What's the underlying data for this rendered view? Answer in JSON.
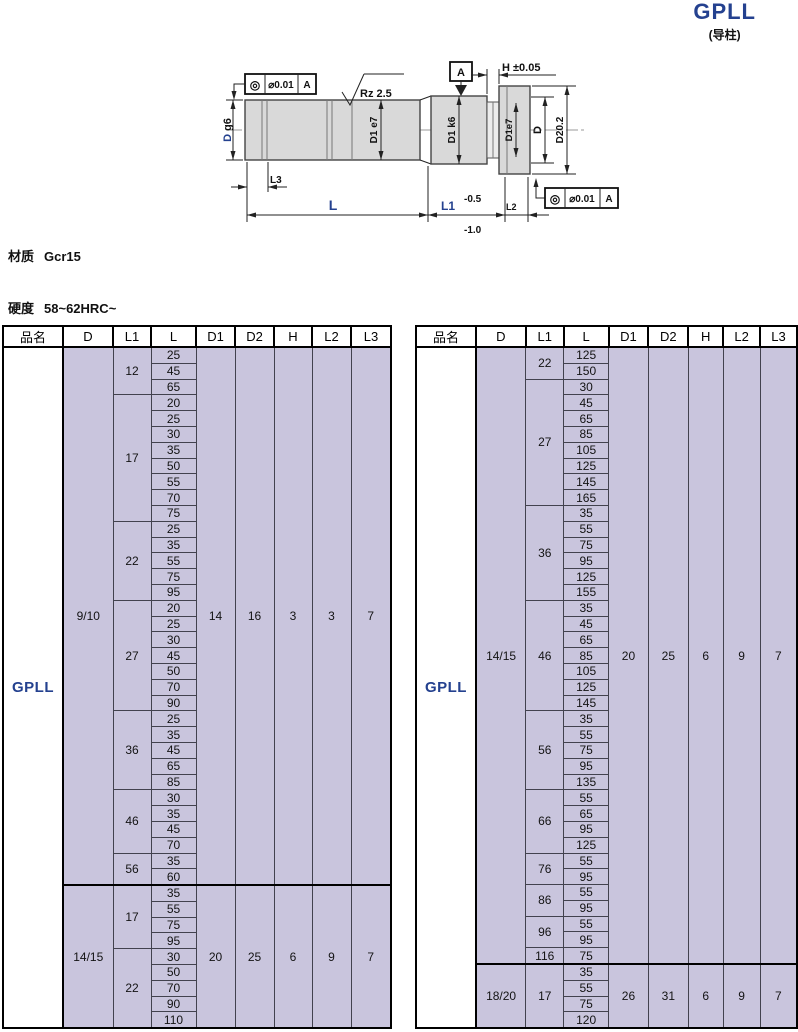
{
  "title": {
    "name": "GPLL",
    "sub": "(导柱)"
  },
  "specs": {
    "material_label": "材质",
    "material_value": "Gcr15",
    "hardness_label": "硬度",
    "hardness_value": "58~62HRC~"
  },
  "drawing": {
    "tolerance_frame": {
      "symbol": "◎",
      "value": "⌀0.01",
      "datum": "A"
    },
    "surface_finish": "Rz 2.5",
    "datum_label": "A",
    "h_dim": "H ±0.05",
    "d_label": "D",
    "d_fit": "g6",
    "d1_e7": "D1 e7",
    "d1_k6": "D1 k6",
    "head_d1e7": "D1e7",
    "head_d": "D",
    "head_d2": "D20.2",
    "l3": "L3",
    "l": "L",
    "l1": "L1",
    "l2": "L2",
    "l1_tol_upper": "-0.5",
    "l1_tol_lower": "-1.0"
  },
  "table_headers": [
    "品名",
    "D",
    "L1",
    "L",
    "D1",
    "D2",
    "H",
    "L2",
    "L3"
  ],
  "tables": [
    {
      "product": "GPLL",
      "groups": [
        {
          "d": "9/10",
          "d1": "14",
          "d2": "16",
          "h": "3",
          "l2": "3",
          "l3": "7",
          "l1_groups": [
            {
              "l1": "12",
              "l": [
                "25",
                "45",
                "65"
              ]
            },
            {
              "l1": "17",
              "l": [
                "20",
                "25",
                "30",
                "35",
                "50",
                "55",
                "70",
                "75"
              ]
            },
            {
              "l1": "22",
              "l": [
                "25",
                "35",
                "55",
                "75",
                "95"
              ]
            },
            {
              "l1": "27",
              "l": [
                "20",
                "25",
                "30",
                "45",
                "50",
                "70",
                "90"
              ]
            },
            {
              "l1": "36",
              "l": [
                "25",
                "35",
                "45",
                "65",
                "85"
              ]
            },
            {
              "l1": "46",
              "l": [
                "30",
                "35",
                "45",
                "70"
              ]
            },
            {
              "l1": "56",
              "l": [
                "35",
                "60"
              ]
            }
          ]
        },
        {
          "d": "14/15",
          "d1": "20",
          "d2": "25",
          "h": "6",
          "l2": "9",
          "l3": "7",
          "l1_groups": [
            {
              "l1": "17",
              "l": [
                "35",
                "55",
                "75",
                "95"
              ]
            },
            {
              "l1": "22",
              "l": [
                "30",
                "50",
                "70",
                "90",
                "110"
              ]
            }
          ]
        }
      ]
    },
    {
      "product": "GPLL",
      "groups": [
        {
          "d": "14/15",
          "d1": "20",
          "d2": "25",
          "h": "6",
          "l2": "9",
          "l3": "7",
          "l1_groups": [
            {
              "l1": "22",
              "l": [
                "125",
                "150"
              ]
            },
            {
              "l1": "27",
              "l": [
                "30",
                "45",
                "65",
                "85",
                "105",
                "125",
                "145",
                "165"
              ]
            },
            {
              "l1": "36",
              "l": [
                "35",
                "55",
                "75",
                "95",
                "125",
                "155"
              ]
            },
            {
              "l1": "46",
              "l": [
                "35",
                "45",
                "65",
                "85",
                "105",
                "125",
                "145"
              ]
            },
            {
              "l1": "56",
              "l": [
                "35",
                "55",
                "75",
                "95",
                "135"
              ]
            },
            {
              "l1": "66",
              "l": [
                "55",
                "65",
                "95",
                "125"
              ]
            },
            {
              "l1": "76",
              "l": [
                "55",
                "95"
              ]
            },
            {
              "l1": "86",
              "l": [
                "55",
                "95"
              ]
            },
            {
              "l1": "96",
              "l": [
                "55",
                "95"
              ]
            },
            {
              "l1": "116",
              "l": [
                "75"
              ]
            }
          ]
        },
        {
          "d": "18/20",
          "d1": "26",
          "d2": "31",
          "h": "6",
          "l2": "9",
          "l3": "7",
          "l1_groups": [
            {
              "l1": "17",
              "l": [
                "35",
                "55",
                "75",
                "120"
              ]
            }
          ]
        }
      ]
    }
  ],
  "colors": {
    "accent_blue": "#24418f",
    "cell_bg": "#c9c5dd",
    "shaft_fill": "#d9d9d9"
  }
}
